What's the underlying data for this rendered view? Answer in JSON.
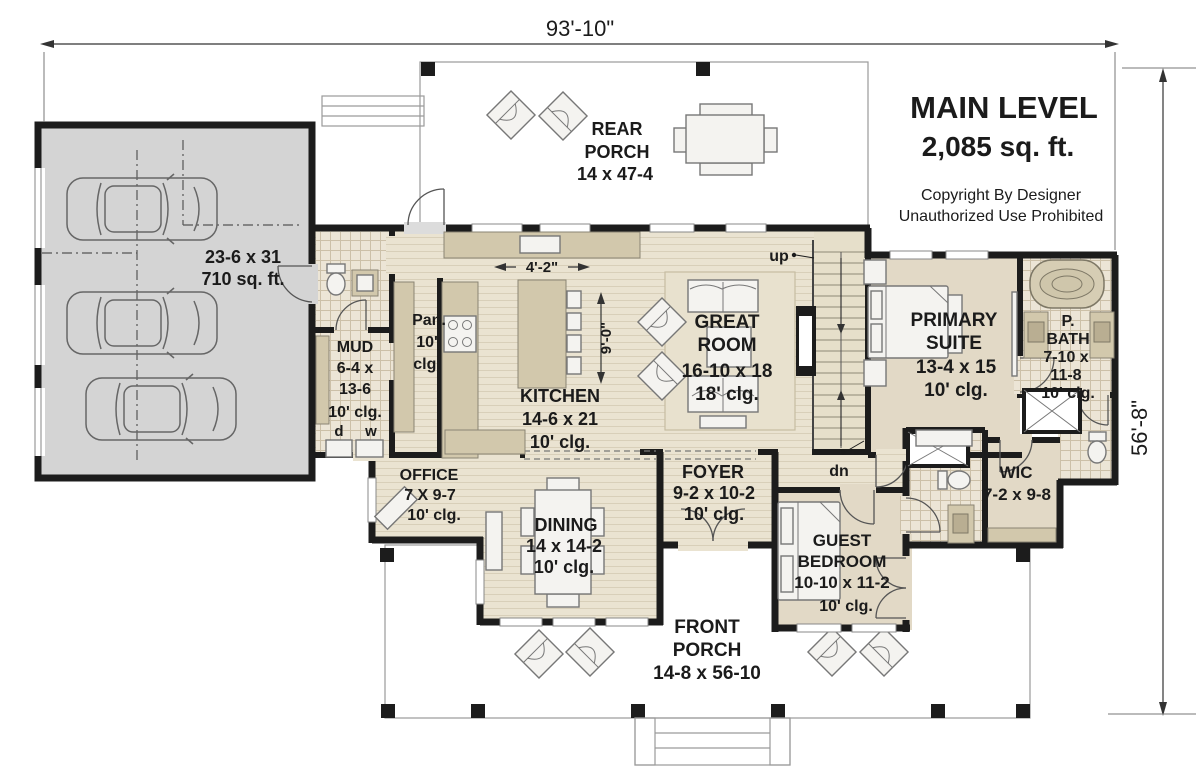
{
  "title_block": {
    "title": "MAIN LEVEL",
    "area": "2,085 sq. ft.",
    "copyright_line1": "Copyright By Designer",
    "copyright_line2": "Unauthorized Use Prohibited"
  },
  "dimensions": {
    "overall_width": "93'-10\"",
    "overall_height": "56'-8\""
  },
  "rooms": {
    "rear_porch": {
      "lines": [
        "REAR",
        "PORCH",
        "14 x 47-4"
      ]
    },
    "garage": {
      "lines": [
        "23-6 x 31",
        "710 sq. ft."
      ]
    },
    "mud": {
      "lines": [
        "MUD",
        "6-4 x",
        "13-6",
        "10' clg."
      ]
    },
    "pantry": {
      "lines": [
        "Pan.",
        "10'",
        "clg."
      ]
    },
    "kitchen": {
      "lines": [
        "KITCHEN",
        "14-6 x 21",
        "10' clg."
      ],
      "island_width": "4'-2\"",
      "island_depth": "9'-0\""
    },
    "great_room": {
      "lines": [
        "GREAT",
        "ROOM",
        "16-10 x 18",
        "18' clg."
      ]
    },
    "primary_suite": {
      "lines": [
        "PRIMARY",
        "SUITE",
        "13-4 x 15",
        "10' clg."
      ]
    },
    "primary_bath": {
      "lines": [
        "P.",
        "BATH",
        "7-10 x",
        "11-8",
        "10' clg."
      ]
    },
    "office": {
      "lines": [
        "OFFICE",
        "7 X 9-7",
        "10' clg."
      ]
    },
    "dining": {
      "lines": [
        "DINING",
        "14 x 14-2",
        "10' clg."
      ]
    },
    "foyer": {
      "lines": [
        "FOYER",
        "9-2 x 10-2",
        "10' clg."
      ]
    },
    "guest_bedroom": {
      "lines": [
        "GUEST",
        "BEDROOM",
        "10-10 x 11-2",
        "10' clg."
      ]
    },
    "wic": {
      "lines": [
        "WIC",
        "7-2 x 9-8"
      ]
    },
    "front_porch": {
      "lines": [
        "FRONT",
        "PORCH",
        "14-8 x 56-10"
      ]
    }
  },
  "stairs": {
    "up": "up",
    "down": "dn"
  },
  "laundry": {
    "dryer": "d",
    "washer": "w"
  },
  "colors": {
    "wall": "#1c1c1c",
    "porch": "#dcdcdc",
    "garage_floor": "#d4d4d4",
    "wood_floor": "#eae3d1",
    "wood_stripe": "#d8cfb9",
    "tile": "#ece5d6",
    "tile_grid": "#ccc0a8",
    "carpet": "#e2d9c6",
    "cabinet": "#d2c8ac",
    "furniture": "#f4f3f0",
    "rug": "#e8e1ce",
    "text": "#1b1b1b"
  }
}
